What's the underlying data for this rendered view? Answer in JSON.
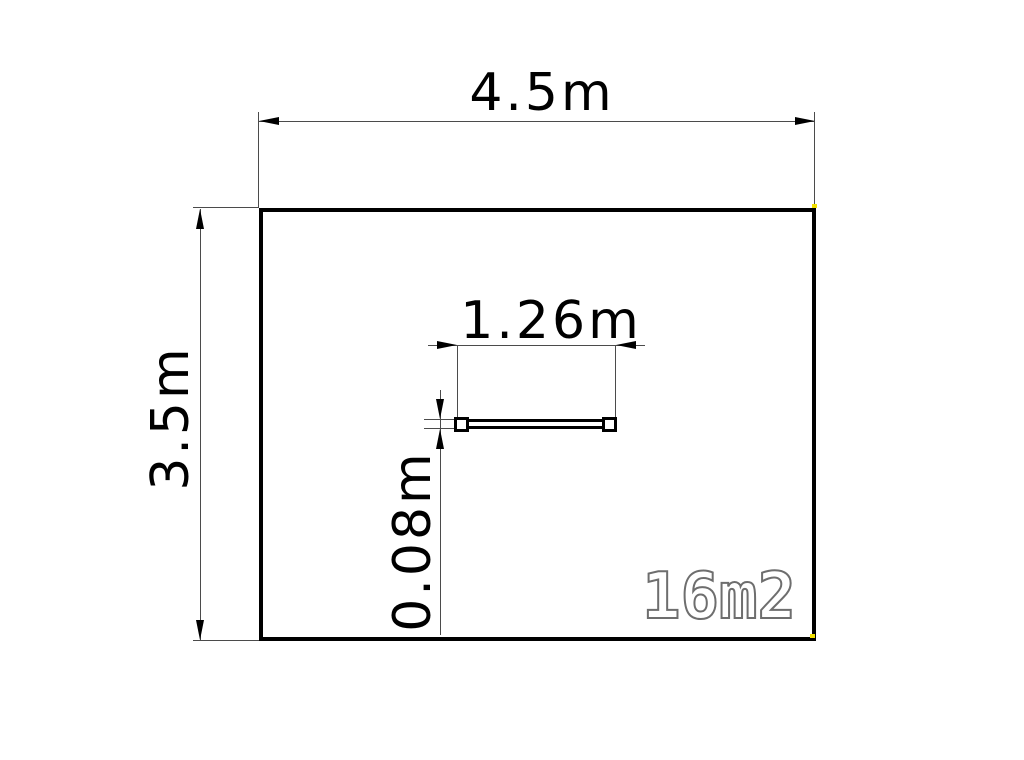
{
  "drawing": {
    "kind": "floor-plan",
    "room": {
      "width_label": "4.5m",
      "height_label": "3.5m",
      "area_label": "16m2"
    },
    "window": {
      "width_label": "1.26m",
      "thickness_label": "0.08m"
    }
  },
  "colors": {
    "wall": "#000000",
    "dimline": "#4b4b4b",
    "dimtext": "#000000",
    "area_outline": "#6e6e6e",
    "grip": "#f2e000"
  }
}
